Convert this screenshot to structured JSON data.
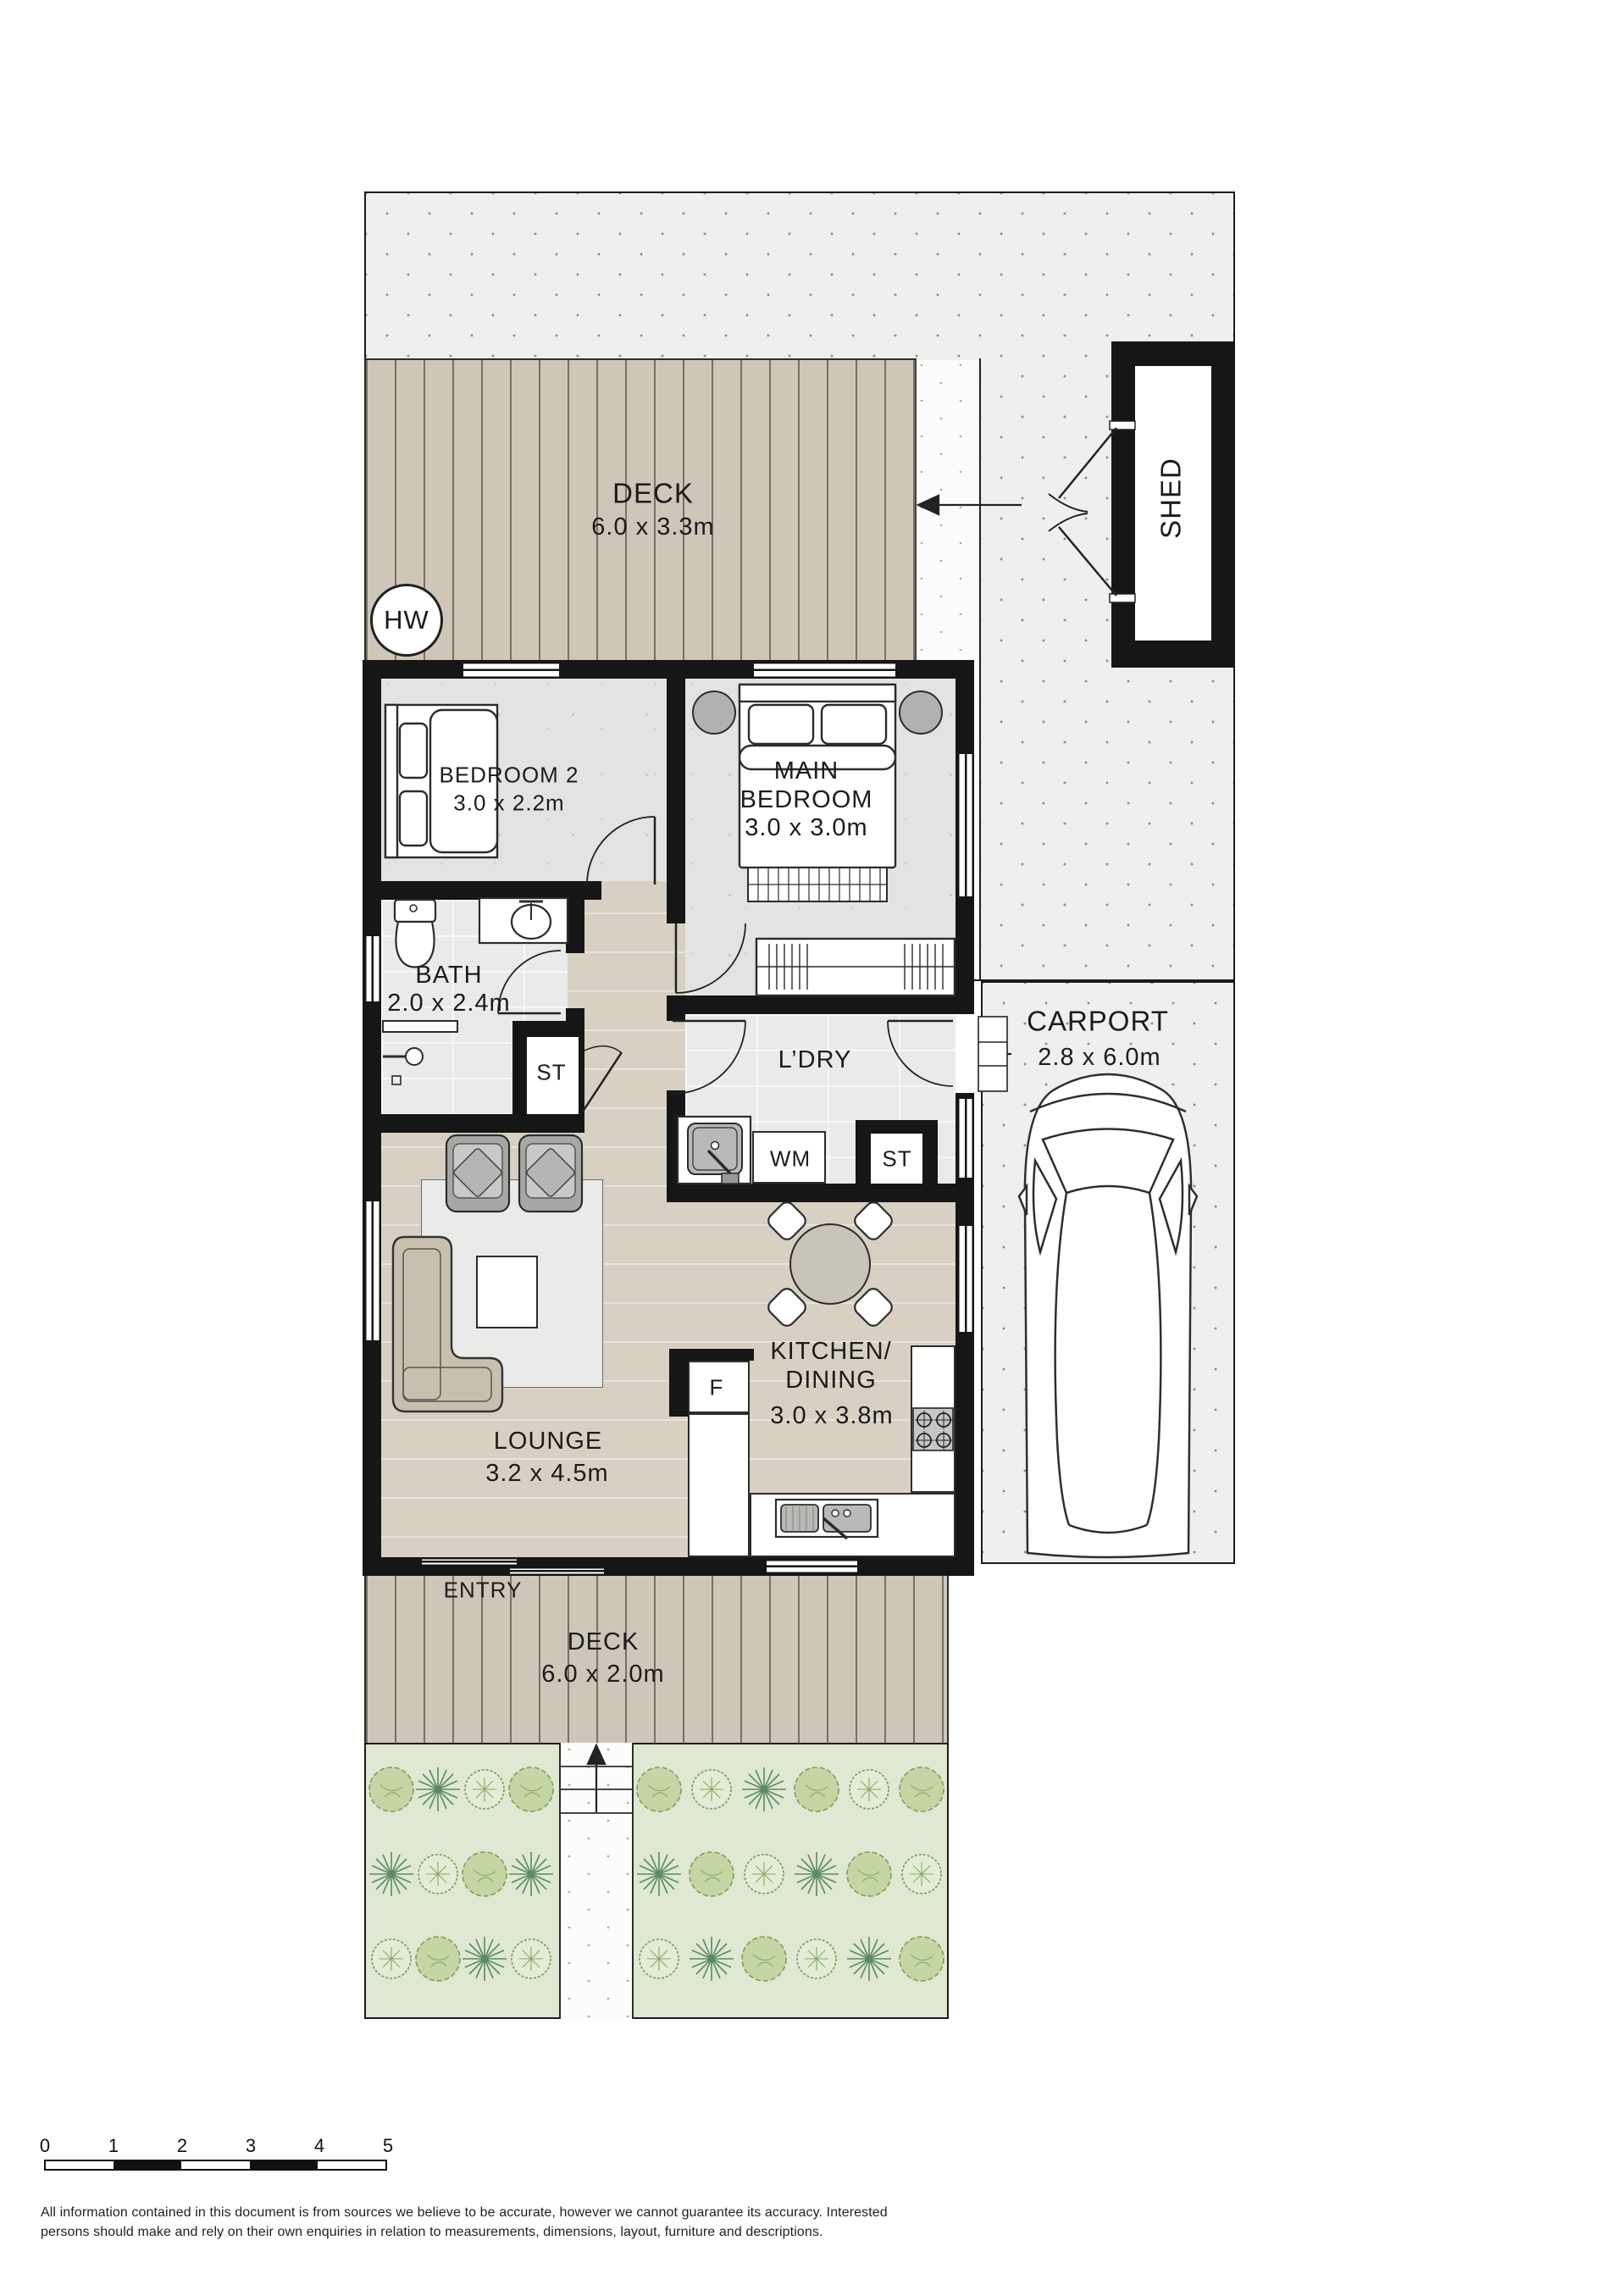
{
  "labels": {
    "deck_top": {
      "name": "DECK",
      "dim": "6.0 x 3.3m"
    },
    "shed": "SHED",
    "hw": "HW",
    "bedroom2": {
      "name": "BEDROOM 2",
      "dim": "3.0 x 2.2m"
    },
    "main_bedroom": {
      "name": "MAIN\nBEDROOM",
      "dim": "3.0 x 3.0m"
    },
    "bath": {
      "name": "BATH",
      "dim": "2.0 x 2.4m"
    },
    "st_bath": "ST",
    "laundry": "L’DRY",
    "wm": "WM",
    "st_laundry": "ST",
    "carport": {
      "name": "CARPORT",
      "dim": "2.8 x 6.0m"
    },
    "lounge": {
      "name": "LOUNGE",
      "dim": "3.2 x 4.5m"
    },
    "kitchen": {
      "name": "KITCHEN/\nDINING",
      "dim": "3.0 x 3.8m"
    },
    "fridge": "F",
    "entry": "ENTRY",
    "deck_bottom": {
      "name": "DECK",
      "dim": "6.0 x 2.0m"
    }
  },
  "scale_bar": {
    "labels": [
      "0",
      "1",
      "2",
      "3",
      "4",
      "5"
    ]
  },
  "disclaimer": {
    "line1": "All information contained in this document is from sources we believe to be accurate, however we cannot guarantee its accuracy. Interested",
    "line2": "persons should make and rely on their own enquiries in relation to measurements, dimensions, layout, furniture and descriptions."
  },
  "colors": {
    "wall": "#161616",
    "deck": "#cdc6b9",
    "floor": "#d8d1c3",
    "room": "#e3e4e2",
    "tile": "#e9eaea",
    "paving": "#eff0ee",
    "garden": "#dfe8d2",
    "plant_green": "#7da05c",
    "text": "#1c1c1c"
  }
}
